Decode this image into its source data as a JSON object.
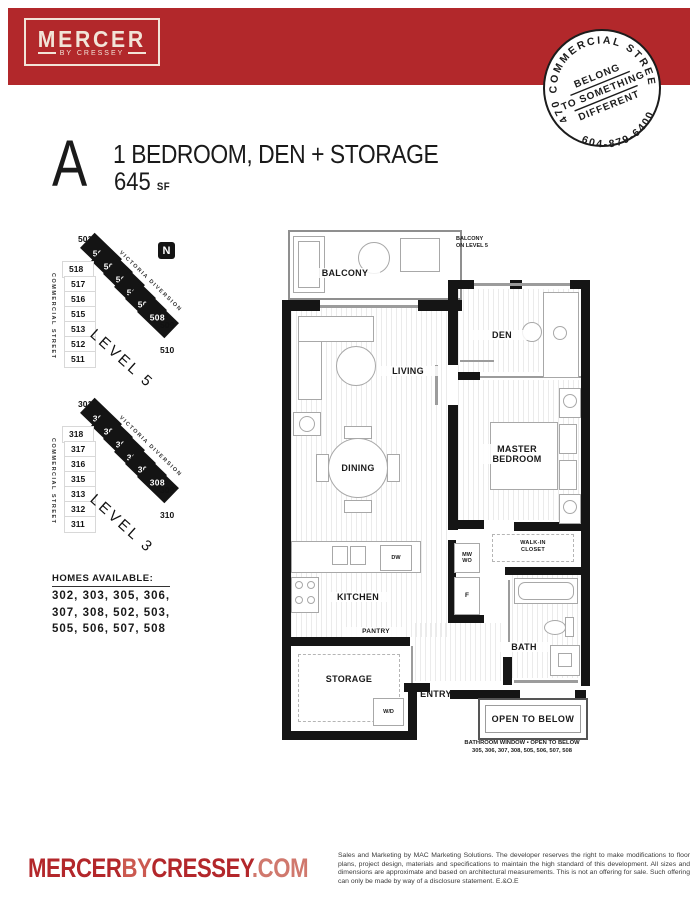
{
  "header": {
    "logo_name": "MERCER",
    "logo_tagline": "BY CRESSEY",
    "bar_color": "#b2282b"
  },
  "stamp": {
    "top_text": "3470 COMMERCIAL STREET",
    "phone": "604-879-6400",
    "line1": "BELONG",
    "line2": "TO SOMETHING",
    "line3": "DIFFERENT"
  },
  "plan": {
    "letter": "A",
    "title": "1 BEDROOM, DEN + STORAGE",
    "area": "645",
    "area_unit": "SF"
  },
  "keyplans": [
    {
      "level": "LEVEL 5",
      "north": "N",
      "first": "501",
      "street_v": "COMMERCIAL STREET",
      "street_d": "VICTORIA DIVERSION",
      "units": [
        "502",
        "503",
        "505",
        "506",
        "507",
        "508"
      ],
      "right": [
        "509",
        "510"
      ],
      "left": [
        "518",
        "517",
        "516",
        "515",
        "513",
        "512",
        "511"
      ]
    },
    {
      "level": "LEVEL 3",
      "first": "301",
      "street_v": "COMMERCIAL STREET",
      "street_d": "VICTORIA DIVERSION",
      "units": [
        "302",
        "303",
        "305",
        "306",
        "307",
        "308"
      ],
      "right": [
        "309",
        "310"
      ],
      "left": [
        "318",
        "317",
        "316",
        "315",
        "313",
        "312",
        "311"
      ]
    }
  ],
  "homes": {
    "heading": "HOMES AVAILABLE:",
    "lines": [
      "302, 303, 305, 306,",
      "307, 308, 502, 503,",
      "505, 506, 507, 508"
    ]
  },
  "fp": {
    "balcony": "BALCONY",
    "note1": "BALCONY",
    "note2": "ON LEVEL 5",
    "living": "LIVING",
    "dining": "DINING",
    "den": "DEN",
    "master1": "MASTER",
    "master2": "BEDROOM",
    "walkin1": "WALK-IN",
    "walkin2": "CLOSET",
    "kitchen": "KITCHEN",
    "pantry": "PANTRY",
    "bath": "BATH",
    "storage": "STORAGE",
    "entry": "ENTRY",
    "open_below": "OPEN TO BELOW",
    "dw": "DW",
    "f": "F",
    "mwwo1": "MW",
    "mwwo2": "WO",
    "wd": "W/D",
    "footnote1": "BATHROOM WINDOW • OPEN TO BELOW",
    "footnote2": "305, 306, 307, 308, 505, 506, 507, 508"
  },
  "footer": {
    "brand1": "MERCER",
    "brand2": "BY",
    "brand3": "CRESSEY",
    "brand4": ".COM",
    "disclaimer": "Sales and Marketing by MAC Marketing Solutions. The developer reserves the right to make modifications to floor plans, project design, materials and specifications to maintain the high standard of this development. All sizes and dimensions are approximate and based on architectural measurements. This is not an offering for sale. Such offering can only be made by way of a disclosure statement. E.&O.E"
  }
}
